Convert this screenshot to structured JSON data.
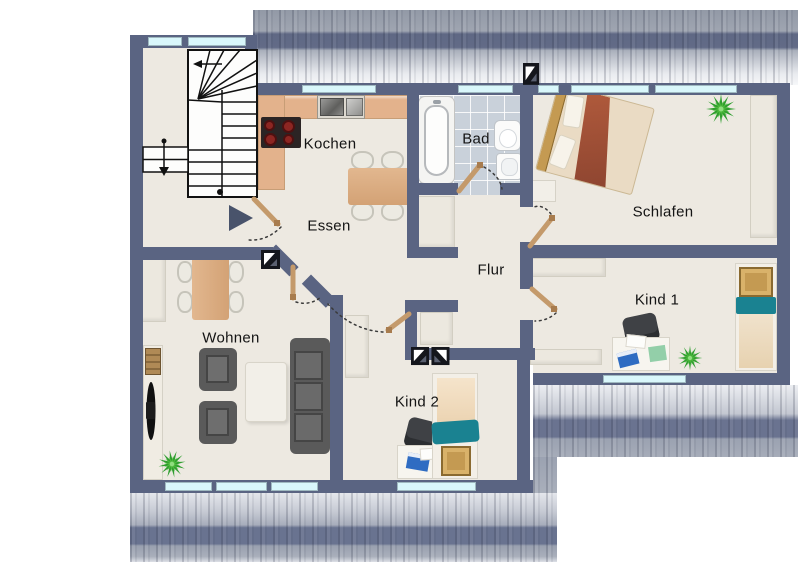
{
  "plan": {
    "rooms": [
      {
        "id": "kochen",
        "label": "Kochen"
      },
      {
        "id": "essen",
        "label": "Essen"
      },
      {
        "id": "bad",
        "label": "Bad"
      },
      {
        "id": "schlafen",
        "label": "Schlafen"
      },
      {
        "id": "flur",
        "label": "Flur"
      },
      {
        "id": "kind1",
        "label": "Kind 1"
      },
      {
        "id": "wohnen",
        "label": "Wohnen"
      },
      {
        "id": "kind2",
        "label": "Kind 2"
      }
    ],
    "colors": {
      "wall": "#5a6482",
      "floor": "#ede9e1",
      "window": "#d9f7fb",
      "tile": "#c9d1da",
      "counter": "#e3b28c",
      "door": "#c49a6b",
      "sofa": "#5a5a5a",
      "bed_blanket": "#a5543a",
      "kids_blanket": "#1a8291",
      "wood": "#c49a52",
      "plant": "#2e9e2e",
      "arrow": "#49536b"
    },
    "icons": [
      "skylight-icon",
      "entrance-arrow-icon",
      "stairs-symbol",
      "plant-icon"
    ]
  }
}
